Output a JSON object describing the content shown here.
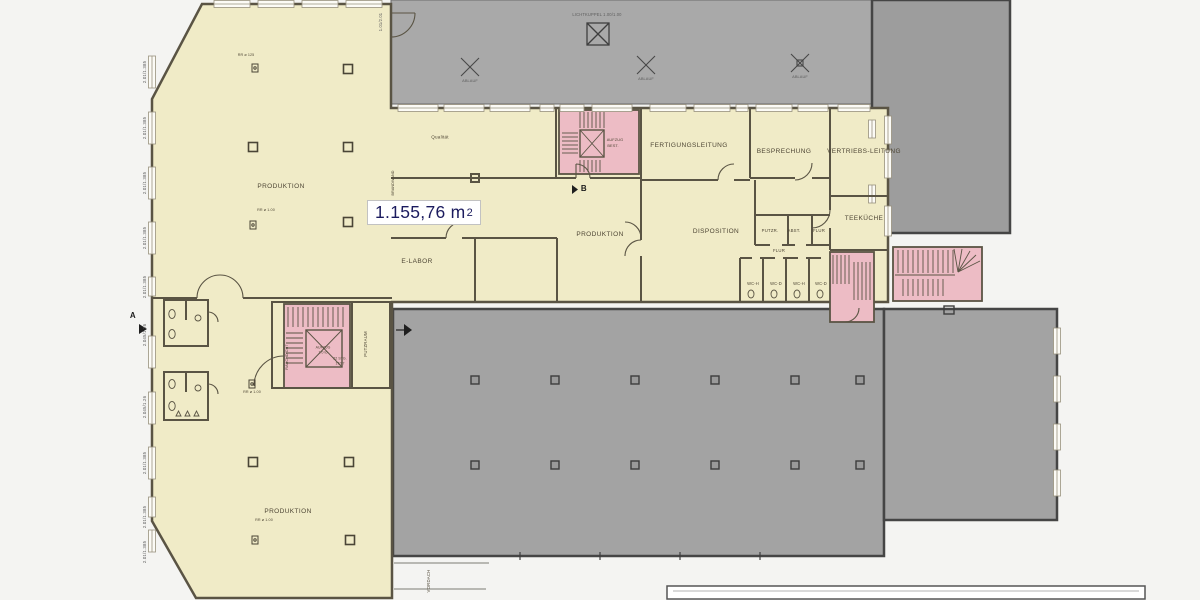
{
  "annotation": {
    "area_value": "1.155,76 m",
    "area_sup": "2"
  },
  "rooms": {
    "produktion_top": "PRODUKTION",
    "produktion_mid": "PRODUKTION",
    "produktion_bottom": "PRODUKTION",
    "qualitaet": "Qualität",
    "aufzug_line1": "AUFZUG",
    "aufzug_line2": "BEST.",
    "fertigungsleitung": "FERTIGUNGSLEITUNG",
    "besprechung": "BESPRECHUNG",
    "vertriebsleitung": "VERTRIEBS-LEITUNG",
    "disposition": "DISPOSITION",
    "elabor": "E-LABOR",
    "putzr": "PUTZR.",
    "abst": "ABST.",
    "flur_upper": "FLUR",
    "flur_lower": "FLUR",
    "teekueche": "TEEKÜCHE",
    "wc_h": "WC-H",
    "wc_d": "WC-D",
    "putzraum": "PUTZRAUM",
    "rauchdicht": "RAUCHDICHT",
    "aufzug2_line1": "AUFZUG",
    "aufzug2_line2": "1.0 to",
    "stg_line1": "22 STG.",
    "stg_line2": "17/27",
    "brandwand": "BRANDWAND",
    "vordach": "VORDACH"
  },
  "roof": {
    "lichtkuppel": "LICHTKUPPEL 1.00/1.00",
    "ablauf": "ABLAUF"
  },
  "drains": {
    "rr125": "RR ø 125",
    "rr100": "RR ø 1.00"
  },
  "dimensions": {
    "left": [
      "2.01/1.385",
      "2.01/1.385",
      "2.01/1.385",
      "2.01/1.385",
      "2.01/1.385",
      "2.045/1.26",
      "2.045/1.26",
      "2.01/1.385",
      "2.01/1.385",
      "2.01/1.385"
    ],
    "door_top": "1.01/2.01"
  },
  "sections": {
    "a": "A",
    "b": "B"
  },
  "colors": {
    "room_fill": "#f0ebc7",
    "stair_fill": "#edbcc5",
    "roof_gray": "#a9a9a9",
    "block_gray": "#9d9d9d",
    "wall": "#5a5444",
    "area_text": "#1b1b5e"
  }
}
